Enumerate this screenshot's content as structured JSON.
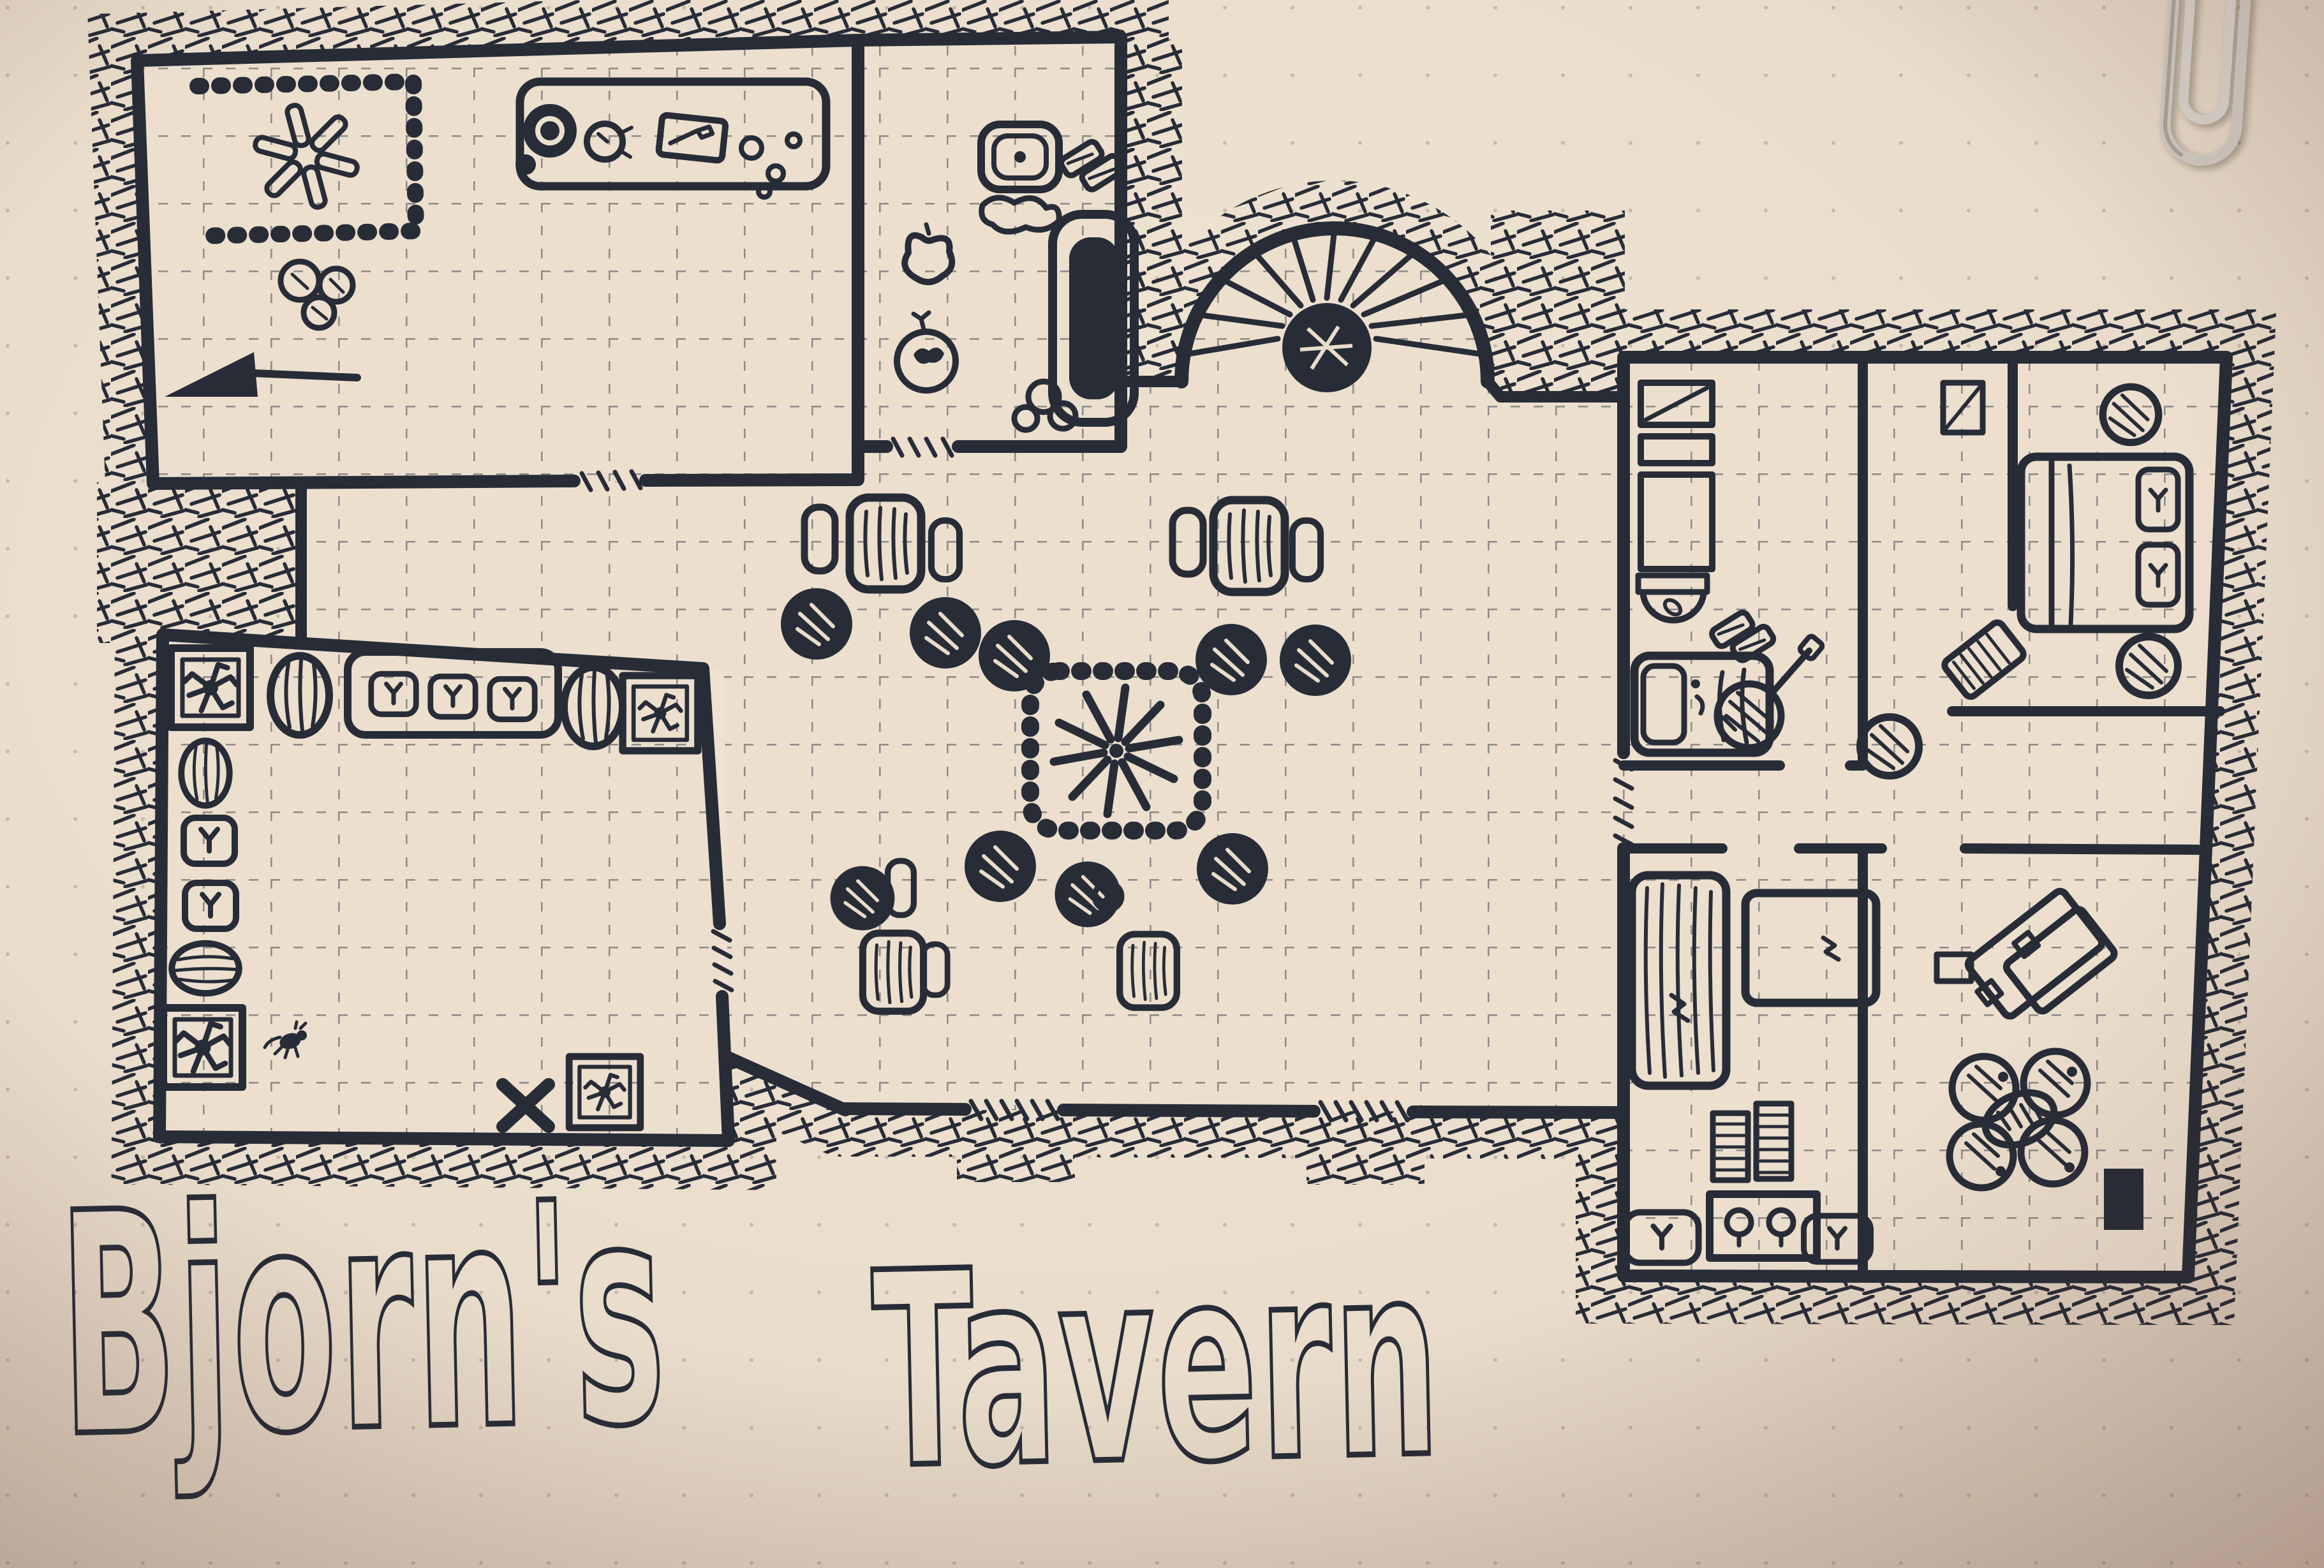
{
  "title": {
    "word1": "Bjorn's",
    "word2": "Tavern"
  },
  "artwork": {
    "kind": "hand-drawn tavern floor plan, black ink on cream paper",
    "rooms": [
      "kitchen",
      "washroom",
      "spiral-stair-landing",
      "main-hall",
      "storage-cellar",
      "bedroom-northwest",
      "bedroom-northeast",
      "bedroom-southwest",
      "bedroom-southeast",
      "corridor"
    ]
  },
  "icons": [
    "hearth-fire-asterisk-icon",
    "stone-hearth-icon",
    "sack-pile-icon",
    "cooking-pot-icon",
    "chicken-icon",
    "cutting-board-knife-icon",
    "food-scraps-icon",
    "cellar-hatch-icon",
    "wash-basin-icon",
    "towel-icon",
    "bathtub-icon",
    "apple-icon",
    "spiral-staircase-icon",
    "stair-post-icon",
    "stone-firepit-icon",
    "round-table-icon",
    "long-table-icon",
    "bench-stool-icon",
    "barrel-icon",
    "crate-icon",
    "rat-icon",
    "bug-icon",
    "supply-sack-icon",
    "floor-x-mark-icon",
    "mirror-shelf-icon",
    "wardrobe-icon",
    "washstand-icon",
    "bed-icon",
    "pillow-icon",
    "lute-icon",
    "plant-pot-icon",
    "book-icon",
    "dresser-icon",
    "drawer-chest-icon",
    "desk-icon",
    "clover-seat-icon",
    "door-mat-icon",
    "paperclip"
  ],
  "colors": {
    "paper": "#ecdfce",
    "paper_edge": "#cdbbab",
    "ink": "#272c37",
    "paperclip_silver": "#cfc9c1"
  }
}
